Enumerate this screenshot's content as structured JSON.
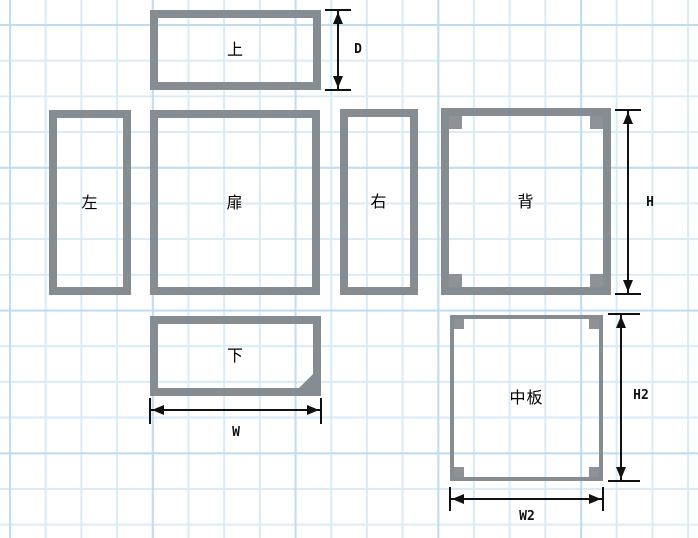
{
  "diagram": {
    "panels": [
      {
        "id": "top",
        "label": "上"
      },
      {
        "id": "left",
        "label": "左"
      },
      {
        "id": "door",
        "label": "扉"
      },
      {
        "id": "right",
        "label": "右"
      },
      {
        "id": "back",
        "label": "背"
      },
      {
        "id": "bottom",
        "label": "下"
      },
      {
        "id": "shelf",
        "label": "中板"
      }
    ],
    "dimensions": {
      "depth": {
        "label": "D"
      },
      "height": {
        "label": "H"
      },
      "width": {
        "label": "W"
      },
      "shelf_height": {
        "label": "H2"
      },
      "shelf_width": {
        "label": "W2"
      }
    },
    "colors": {
      "panel": "#868D92",
      "corner_block": "#8E9296",
      "grid_minor": "#D9EBF7",
      "grid_major": "#C2DCEF",
      "background": "#FFFFFF",
      "dimension_line": "#111111"
    }
  }
}
